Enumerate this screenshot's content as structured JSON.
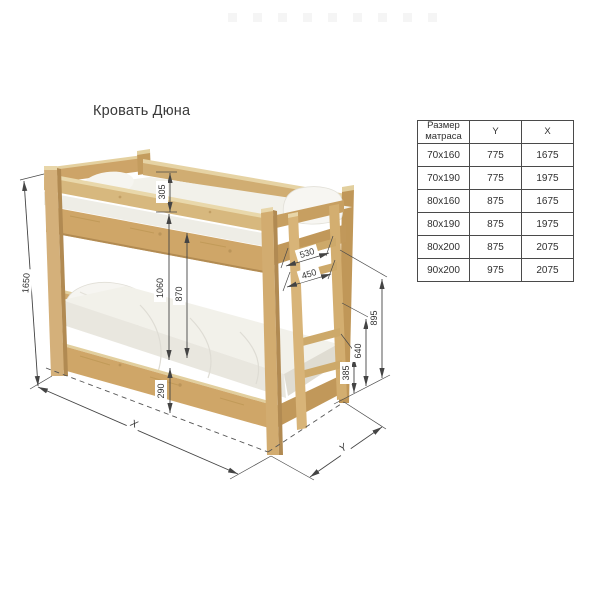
{
  "page": {
    "title": "Кровать Дюна"
  },
  "diagram": {
    "dims": {
      "total_height": "1650",
      "guard_rail_height": "305",
      "bunk_clearance": "1060",
      "under_upper_height": "870",
      "under_bed_height": "290",
      "ladder_outer_width": "530",
      "ladder_inner_width": "450",
      "upper_level_height": "895",
      "mid_rung_height": "640",
      "lower_rung_height": "385",
      "length_label": "X",
      "width_label": "Y"
    }
  },
  "table": {
    "headers": [
      "Размер матраса",
      "Y",
      "X"
    ],
    "rows": [
      [
        "70x160",
        "775",
        "1675"
      ],
      [
        "70x190",
        "775",
        "1975"
      ],
      [
        "80x160",
        "875",
        "1675"
      ],
      [
        "80x190",
        "875",
        "1975"
      ],
      [
        "80x200",
        "875",
        "2075"
      ],
      [
        "90x200",
        "975",
        "2075"
      ]
    ]
  }
}
